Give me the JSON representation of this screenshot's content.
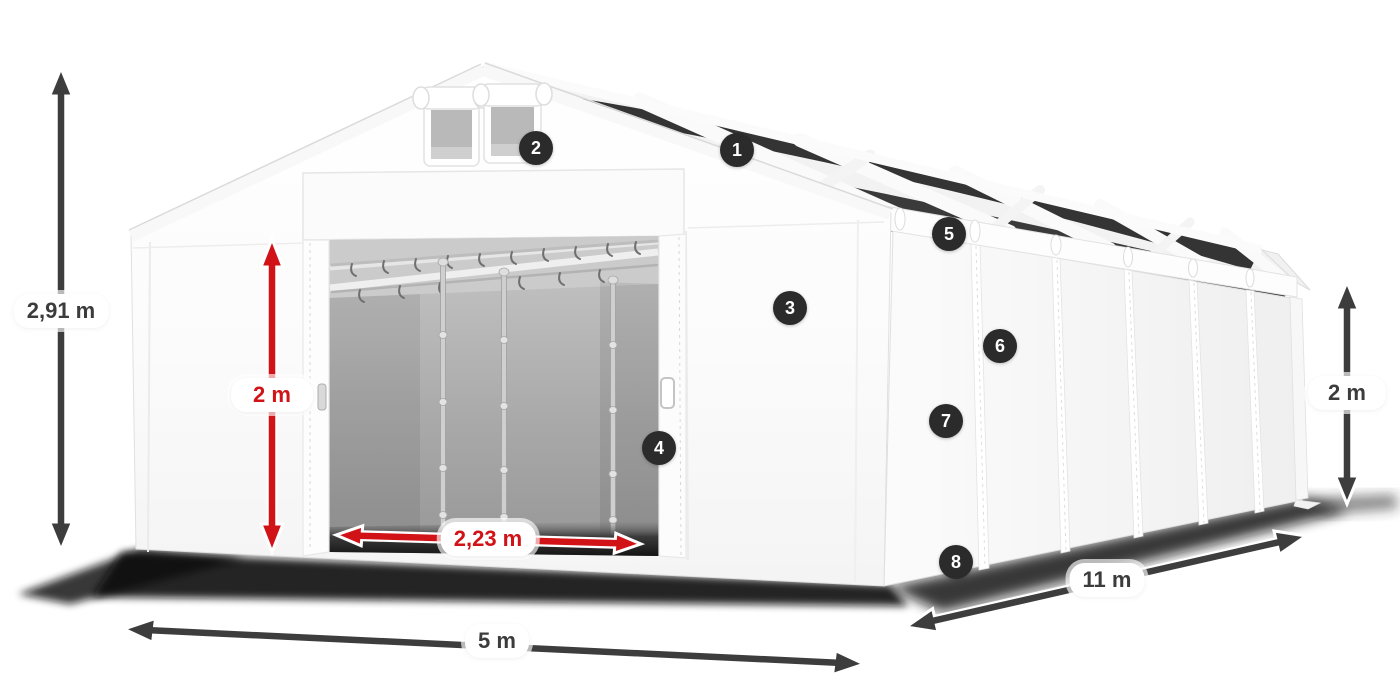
{
  "page": {
    "background": "#ffffff",
    "description": "Storage tent dimension diagram with numbered feature callouts"
  },
  "colors": {
    "dimension_dark": "#3d3d3d",
    "dimension_red": "#d11318",
    "badge_background": "#2b2b2b",
    "badge_text": "#ffffff",
    "label_background": "#ffffff",
    "tent_white": "#ffffff",
    "roof_stripe_dark": "#343434",
    "interior_gray": "#9e9e9e"
  },
  "dimensions": {
    "total_height": {
      "label": "2,91 m"
    },
    "door_height": {
      "label": "2 m"
    },
    "door_width": {
      "label": "2,23 m"
    },
    "front_width": {
      "label": "5 m"
    },
    "side_length": {
      "label": "11 m"
    },
    "side_height": {
      "label": "2 m"
    }
  },
  "callouts": [
    {
      "number": "1"
    },
    {
      "number": "2"
    },
    {
      "number": "3"
    },
    {
      "number": "4"
    },
    {
      "number": "5"
    },
    {
      "number": "6"
    },
    {
      "number": "7"
    },
    {
      "number": "8"
    }
  ]
}
